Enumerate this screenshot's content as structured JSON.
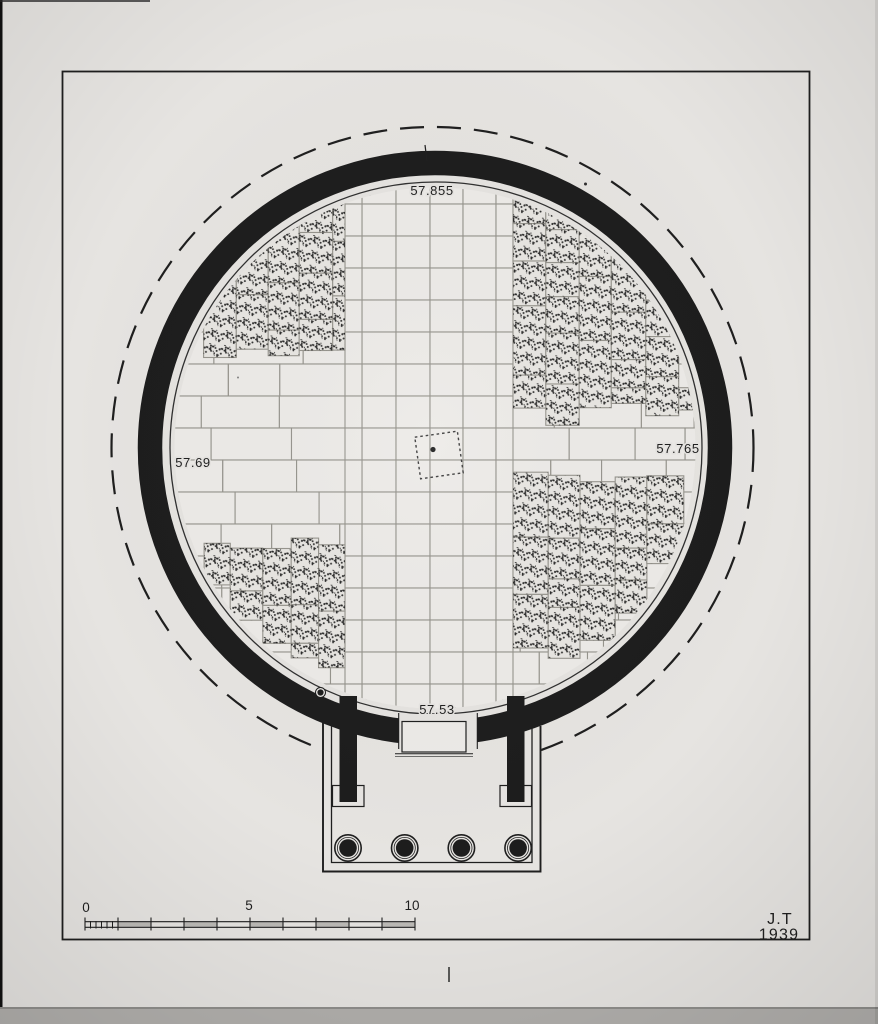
{
  "plan": {
    "elevation_labels": {
      "top": "57.855",
      "left": "57.69",
      "right": "57.765",
      "bottom": "57.53"
    },
    "porch": {
      "column_count": 4
    }
  },
  "scale_bar": {
    "labels": [
      "0",
      "5",
      "10"
    ],
    "units_total": 10
  },
  "signature": {
    "initials": "J.T",
    "year": "1939"
  },
  "colors": {
    "paper": "#e6e4e1",
    "ink": "#1f1f1f",
    "wall_fill": "#1d1d1d",
    "slab": "#edebe8",
    "slab_stippled": "#e8e6e2",
    "joint": "#96948d",
    "photo_band": "#b1afac"
  }
}
